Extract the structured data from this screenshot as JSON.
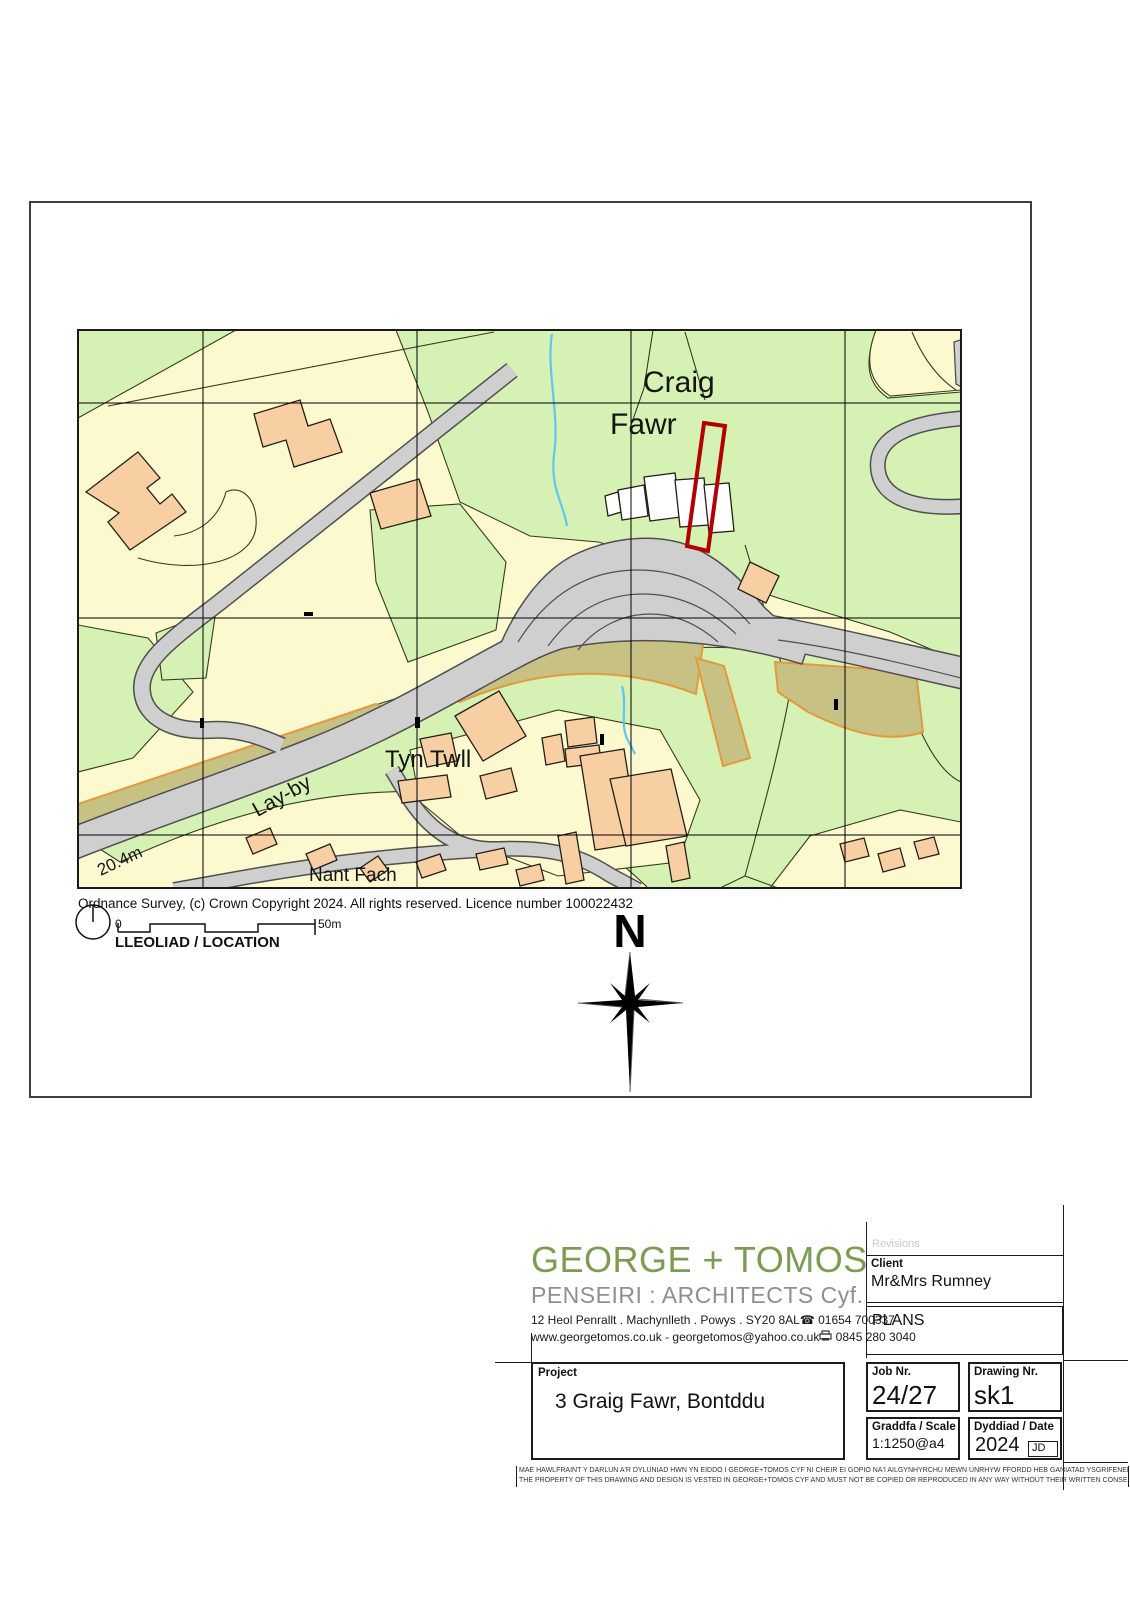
{
  "colors": {
    "field_yellow": "#FCF9CF",
    "field_green": "#D5F1B3",
    "road_gray": "#CFCFCF",
    "road_casing": "#4F4F4F",
    "rough_pasture_olive": "#C7C184",
    "rough_pasture_edge": "#E29A3D",
    "building_peach": "#F8CFA3",
    "site_boundary_red": "#B20000",
    "stream_blue": "#5FC6F2",
    "logo_green": "#7D9C52"
  },
  "map": {
    "place_labels": {
      "craig": "Craig",
      "fawr": "Fawr",
      "tyn_twll": "Tyn Twll",
      "nant_fach": "Nant Fach",
      "lay_by": "Lay-by",
      "spot_height": "20.4m"
    },
    "copyright": "Ordnance Survey, (c) Crown Copyright 2024. All rights reserved. Licence number 100022432",
    "scale_bar": {
      "zero_label": "0",
      "end_label": "50m"
    },
    "location_label": "LLEOLIAD / LOCATION",
    "north_label": "N"
  },
  "title_block": {
    "firm": {
      "name": "GEORGE + TOMOS",
      "subtitle": "PENSEIRI  :  ARCHITECTS Cyf.",
      "address": "12 Heol Penrallt . Machynlleth . Powys . SY20 8AL",
      "phone_icon": "☎",
      "phone": "01654 700337",
      "web": "www.georgetomos.co.uk -  georgetomos@yahoo.co.uk",
      "fax": "0845 280 3040"
    },
    "revisions_label": "Revisions",
    "client": {
      "label": "Client",
      "value": "Mr&Mrs Rumney"
    },
    "plans_label": "PLANS",
    "project": {
      "label": "Project",
      "value": "3 Graig Fawr, Bontddu"
    },
    "job": {
      "label": "Job Nr.",
      "value": "24/27"
    },
    "drawing": {
      "label": "Drawing Nr.",
      "value": "sk1"
    },
    "scale": {
      "label": "Graddfa / Scale",
      "value": "1:1250@a4"
    },
    "date": {
      "label": "Dyddiad / Date",
      "value": "2024",
      "initials": "JD"
    },
    "disclaimer_line1": "MAE HAWLFRAINT Y DARLUN A'R DYLUNIAD HWN YN EIDDO I GEORGE+TOMOS CYF NI CHEIR EI GOPIO NA'I AILGYNHYRCHU MEWN UNRHYW FFORDD HEB GANIATAD YSGRIFENEDIG",
    "disclaimer_line2": "THE PROPERTY OF THIS DRAWING AND DESIGN IS VESTED IN GEORGE+TOMOS CYF AND MUST NOT BE COPIED OR REPRODUCED IN ANY WAY WITHOUT THEIR WRITTEN CONSENT"
  }
}
